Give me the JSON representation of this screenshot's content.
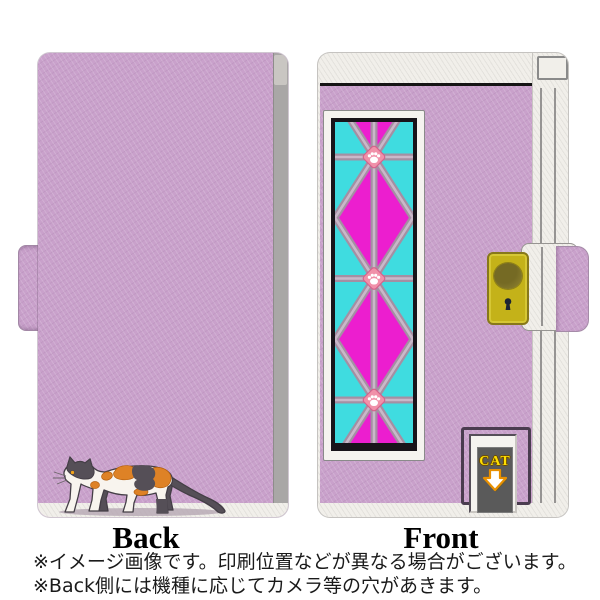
{
  "labels": {
    "back": "Back",
    "front": "Front"
  },
  "cat_sign": {
    "text": "CAT"
  },
  "notes": {
    "line1": "※イメージ画像です。印刷位置などが異なる場合がございます。",
    "line2": "※Back側には機種に応じてカメラ等の穴があきます。"
  },
  "colors": {
    "lavender": "#C9A1CB",
    "spine-gray": "#A9A7A6",
    "notch-gray": "#C9C6C2",
    "cover-white": "#F1EFEA",
    "line-black": "#141414",
    "frame-black": "#18141A",
    "panel-white": "#F5F3EF",
    "magenta": "#EC1ECF",
    "cyan": "#3FDCE0",
    "lattice": "#A48FA3",
    "lattice-light": "#C9B8C9",
    "paw-pink": "#F091A9",
    "paw-edge": "#D4638C",
    "clasp-yellow": "#C4B219",
    "clasp-edge": "#87781A",
    "keyhole": "#1C2433",
    "door-frame": "#4A3C4F",
    "sign-gray": "#5A5A5A",
    "sign-yellow": "#FFDF00",
    "arrow-orange": "#E89000",
    "cat-white": "#F8F4EE",
    "cat-dark": "#554F57",
    "cat-orange": "#DE8226",
    "cat-outline": "#443E46",
    "cat-eye": "#F2A31B",
    "shadow": "#B5A6B3",
    "text-black": "#1A1A1A"
  }
}
